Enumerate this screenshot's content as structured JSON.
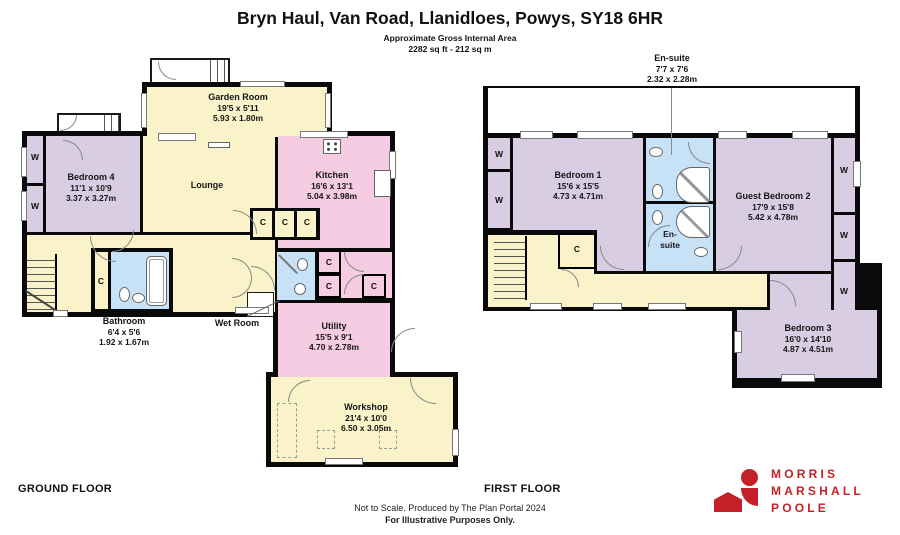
{
  "header": {
    "title": "Bryn Haul, Van Road, Llanidloes, Powys, SY18 6HR",
    "area_label": "Approximate Gross Internal Area",
    "area_value": "2282 sq ft - 212 sq m"
  },
  "markers": {
    "wardrobe": "W",
    "cupboard": "C"
  },
  "ground_floor": {
    "label": "GROUND FLOOR",
    "rooms": {
      "garden_room": {
        "name": "Garden Room",
        "imperial": "19'5 x 5'11",
        "metric": "5.93 x 1.80m"
      },
      "bedroom4": {
        "name": "Bedroom 4",
        "imperial": "11'1 x 10'9",
        "metric": "3.37 x 3.27m"
      },
      "lounge": {
        "name": "Lounge"
      },
      "kitchen": {
        "name": "Kitchen",
        "imperial": "16'6 x 13'1",
        "metric": "5.04 x 3.98m"
      },
      "bathroom": {
        "name": "Bathroom",
        "imperial": "6'4 x 5'6",
        "metric": "1.92 x 1.67m"
      },
      "wet_room": {
        "name": "Wet Room"
      },
      "utility": {
        "name": "Utility",
        "imperial": "15'5 x 9'1",
        "metric": "4.70 x 2.78m"
      },
      "workshop": {
        "name": "Workshop",
        "imperial": "21'4 x 10'0",
        "metric": "6.50 x 3.05m"
      }
    }
  },
  "first_floor": {
    "label": "FIRST FLOOR",
    "ensuite_callout": {
      "name": "En-suite",
      "imperial": "7'7 x 7'6",
      "metric": "2.32 x 2.28m"
    },
    "ensuite_label": {
      "line1": "En-",
      "line2": "suite"
    },
    "rooms": {
      "bedroom1": {
        "name": "Bedroom 1",
        "imperial": "15'6 x 15'5",
        "metric": "4.73 x 4.71m"
      },
      "guest_bedroom2": {
        "name": "Guest Bedroom 2",
        "imperial": "17'9 x 15'8",
        "metric": "5.42 x 4.78m"
      },
      "bedroom3": {
        "name": "Bedroom 3",
        "imperial": "16'0 x 14'10",
        "metric": "4.87 x 4.51m"
      }
    }
  },
  "footer": {
    "scale_note": "Not to Scale. Produced by The Plan Portal 2024",
    "purpose_note": "For Illustrative Purposes Only."
  },
  "logo": {
    "line1": "MORRIS",
    "line2": "MARSHALL",
    "line3": "POOLE"
  },
  "colors": {
    "wall_black": "#0a0a0a",
    "room_cream": "#faf3ca",
    "room_purple": "#d9cde4",
    "room_pink": "#f5cce1",
    "room_blue": "#c7e1f7",
    "logo_red": "#c32127"
  }
}
